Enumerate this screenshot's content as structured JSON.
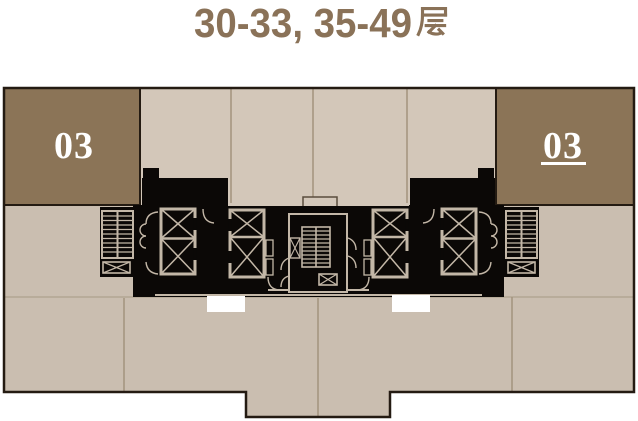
{
  "header": {
    "title": "30-33, 35-49 层",
    "title_latin": "30-33, 35-49",
    "title_cjk_char": "层"
  },
  "units": {
    "left": {
      "label": "03",
      "underlined": false
    },
    "right": {
      "label": "03",
      "underlined": true
    }
  },
  "plan": {
    "upper_unit_panels": 4,
    "elevator_banks": 4,
    "elevator_cars": 8,
    "stairwells": 3,
    "balcony_notches": 2
  },
  "colors": {
    "title_text": "#8A7258",
    "unit_block_fill": "#8B7457",
    "unit_label": "#FFFFFF",
    "floor_upper_fill": "#D3C7B9",
    "floor_lower_fill": "#CABEB0",
    "core_fill": "#0B0806",
    "core_linework": "#C3B7A7",
    "outline": "#241B12",
    "divider_line": "#A3937D",
    "notch_fill": "#FFFFFF",
    "background": "#FFFFFF"
  }
}
